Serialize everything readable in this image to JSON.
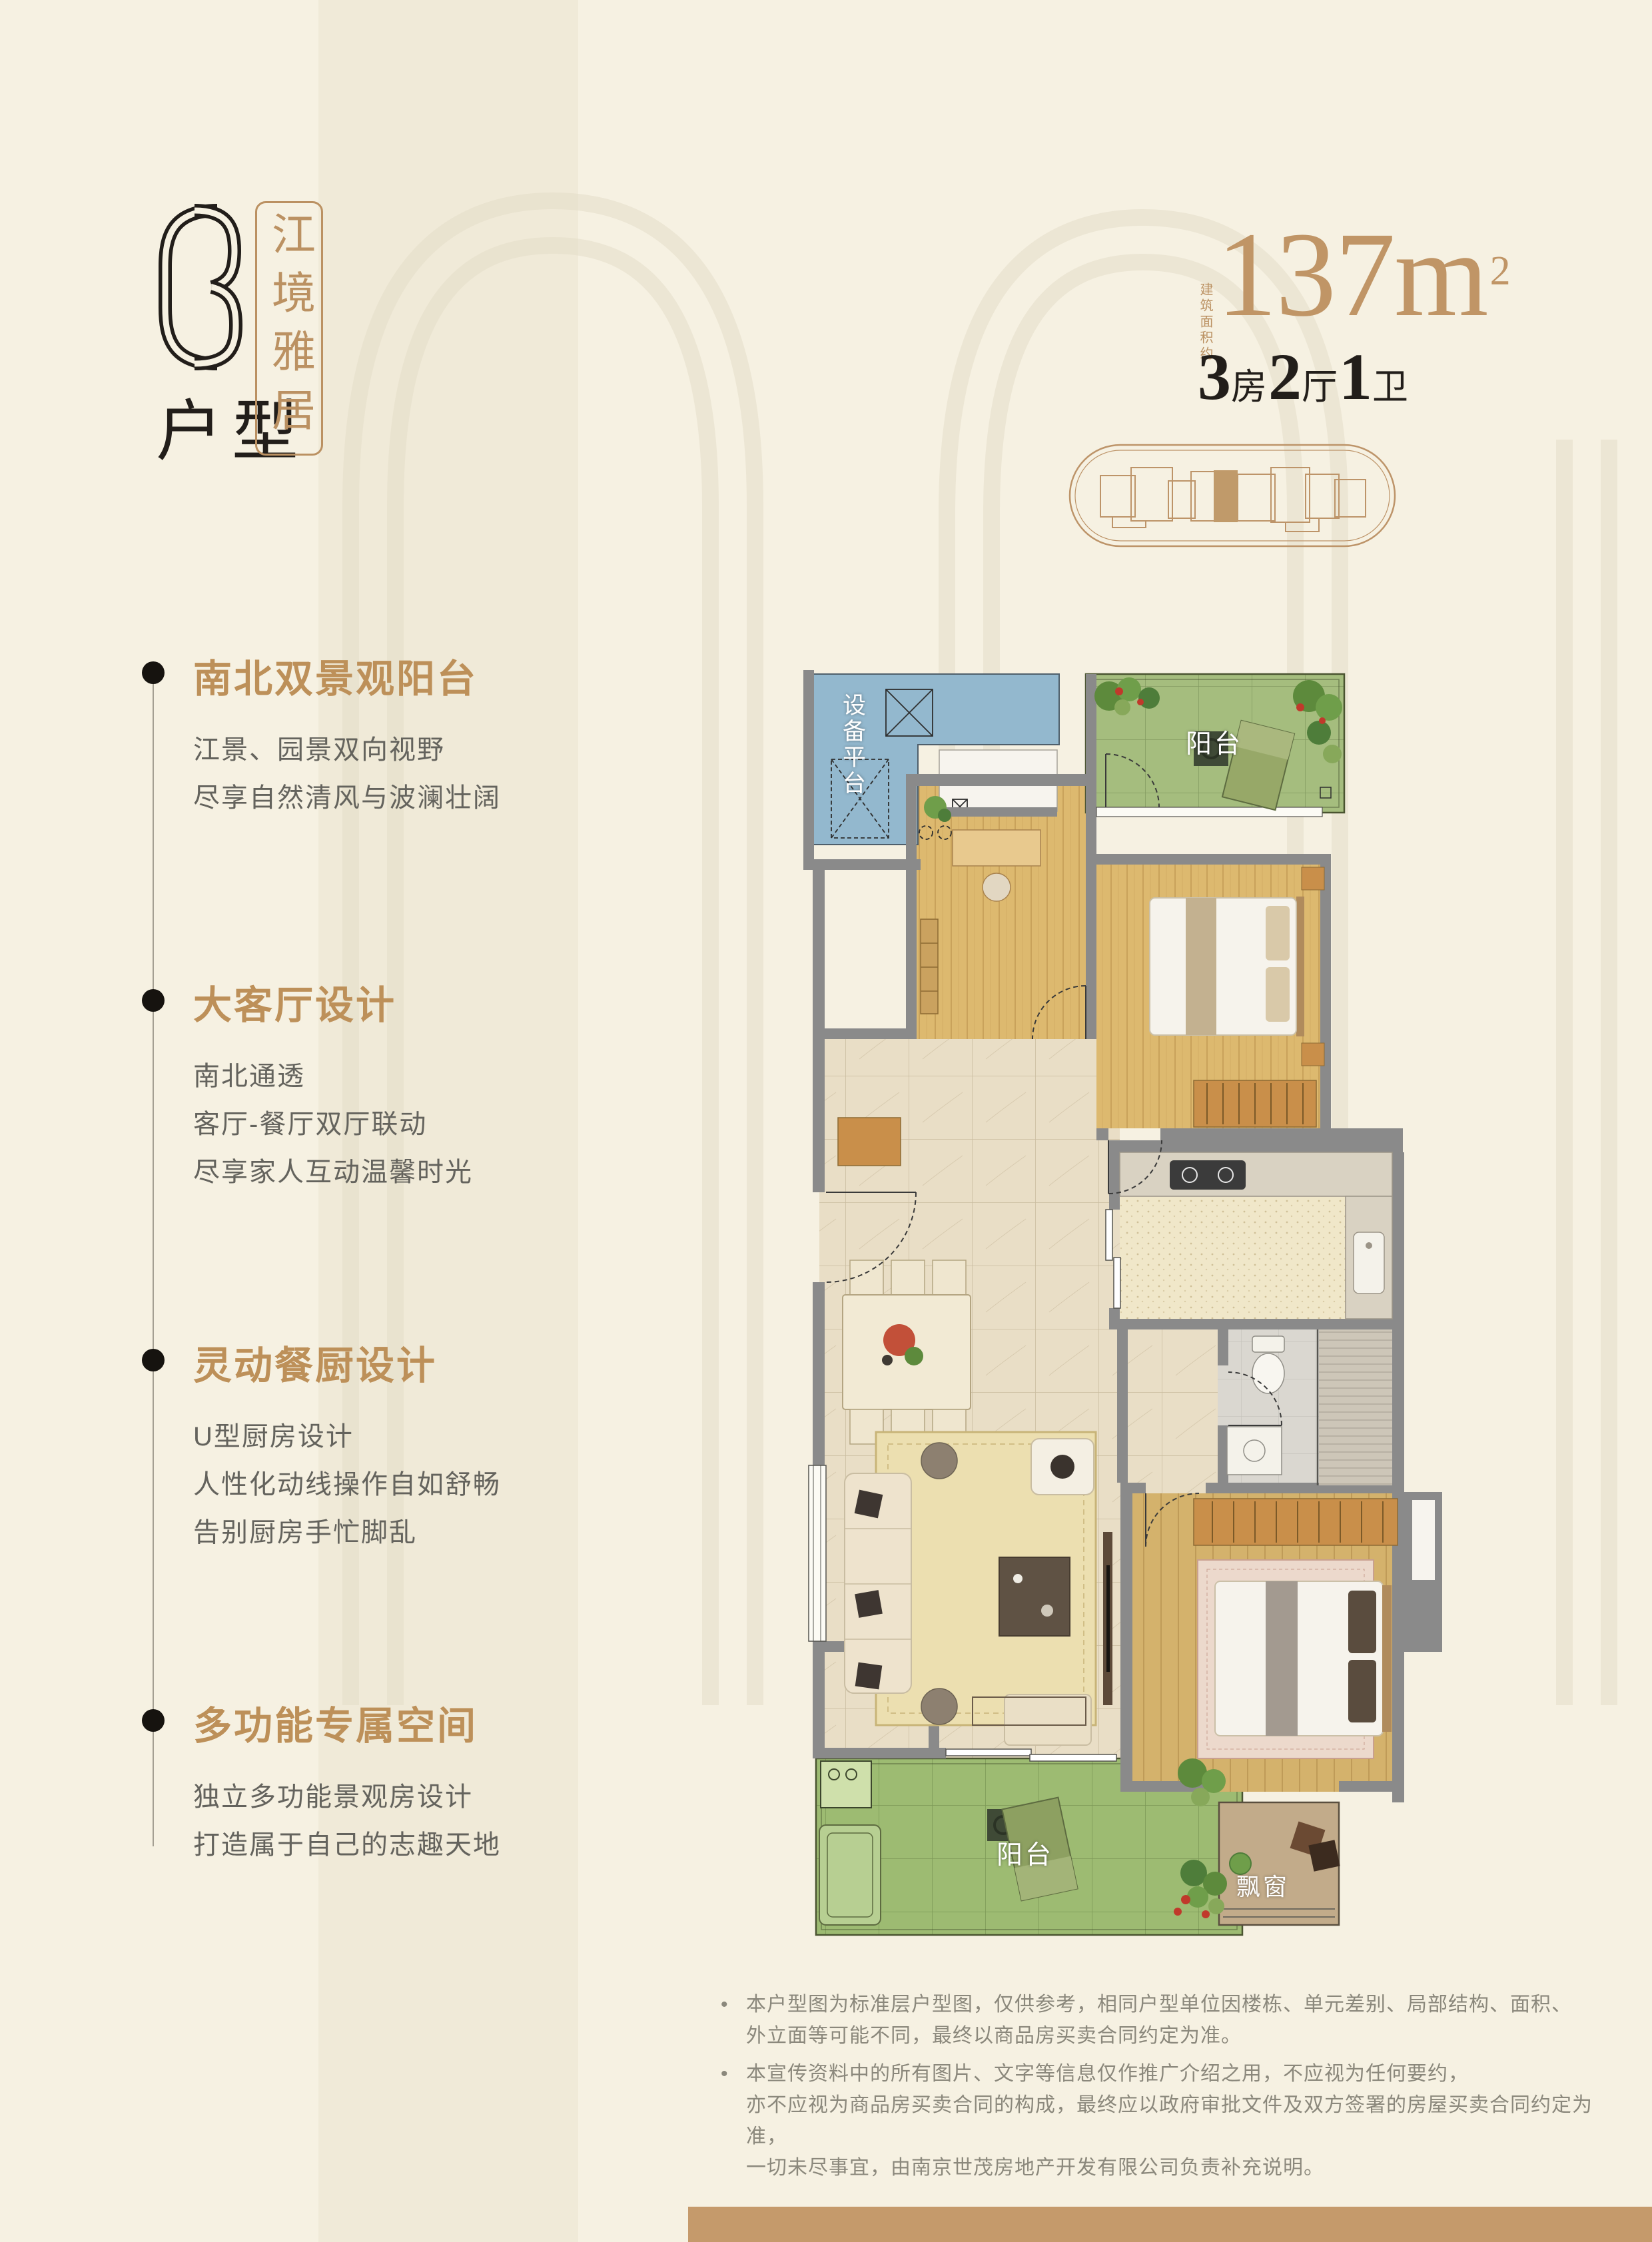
{
  "page": {
    "background": "#f6f1e2",
    "accent_gold": "#bb9162",
    "bar_color": "#c59a6b"
  },
  "header": {
    "unit_code": "C3",
    "unit_code_suffix": "户型",
    "tagline": "江境雅居",
    "area_prefix": "建筑面积约",
    "area_value": "137",
    "area_unit": "m",
    "area_sup": "2",
    "unit_config": [
      {
        "num": "3",
        "label": "房"
      },
      {
        "num": "2",
        "label": "厅"
      },
      {
        "num": "1",
        "label": "卫"
      }
    ]
  },
  "features": [
    {
      "title": "南北双景观阳台",
      "lines": [
        "江景、园景双向视野",
        "尽享自然清风与波澜壮阔"
      ]
    },
    {
      "title": "大客厅设计",
      "lines": [
        "南北通透",
        "客厅-餐厅双厅联动",
        "尽享家人互动温馨时光"
      ]
    },
    {
      "title": "灵动餐厨设计",
      "lines": [
        "U型厨房设计",
        "人性化动线操作自如舒畅",
        "告别厨房手忙脚乱"
      ]
    },
    {
      "title": "多功能专属空间",
      "lines": [
        "独立多功能景观房设计",
        "打造属于自己的志趣天地"
      ]
    }
  ],
  "floorplan": {
    "labels": {
      "equipment_platform": "设备平台",
      "balcony_north": "阳台",
      "balcony_south": "阳台",
      "bay_window": "飘窗"
    }
  },
  "disclaimer": [
    {
      "lines": [
        "本户型图为标准层户型图，仅供参考，相同户型单位因楼栋、单元差别、局部结构、面积、",
        "外立面等可能不同，最终以商品房买卖合同约定为准。"
      ]
    },
    {
      "lines": [
        "本宣传资料中的所有图片、文字等信息仅作推广介绍之用，不应视为任何要约，",
        "亦不应视为商品房买卖合同的构成，最终应以政府审批文件及双方签署的房屋买卖合同约定为准，",
        "一切未尽事宜，由南京世茂房地产开发有限公司负责补充说明。"
      ]
    }
  ]
}
